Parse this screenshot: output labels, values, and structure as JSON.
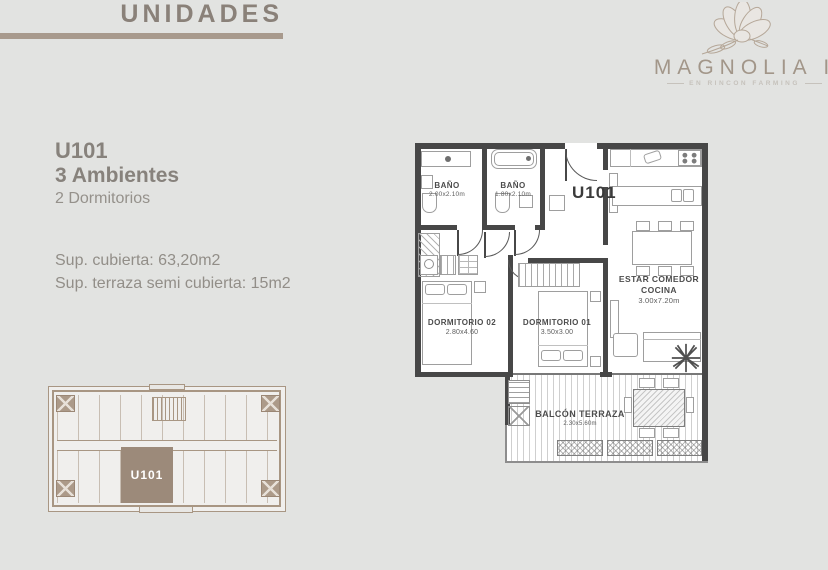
{
  "page": {
    "title": "UNIDADES"
  },
  "brand": {
    "name": "MAGNOLIA I",
    "tagline": "EN RINCON FARMING",
    "flower_icon": "magnolia-flower-icon"
  },
  "unit": {
    "id": "U101",
    "type": "3 Ambientes",
    "bedrooms": "2 Dormitorios",
    "covered": "Sup. cubierta: 63,20m2",
    "terrace": "Sup. terraza semi cubierta: 15m2"
  },
  "floorplan": {
    "unit_label": "U101",
    "bano1": {
      "name": "BAÑO",
      "dims": "2.00x2.10m"
    },
    "bano2": {
      "name": "BAÑO",
      "dims": "1.80x2.10m"
    },
    "dorm2": {
      "name": "DORMITORIO 02",
      "dims": "2.80x4.60"
    },
    "dorm1": {
      "name": "DORMITORIO 01",
      "dims": "3.50x3.00"
    },
    "estar": {
      "line1": "ESTAR COMEDOR",
      "line2": "COCINA",
      "dims": "3.00x7.20m"
    },
    "balcon": {
      "name": "BALCÓN TERRAZA",
      "dims": "2.30x5.60m"
    }
  },
  "keyplan": {
    "highlight_label": "U101"
  },
  "colors": {
    "page_bg": "#e2e3e1",
    "accent_taupe": "#a89a8d",
    "text_taupe": "#8a8179",
    "wall": "#474747",
    "keyplan_line": "#a89683",
    "highlight_fill": "#9c8a7a"
  }
}
